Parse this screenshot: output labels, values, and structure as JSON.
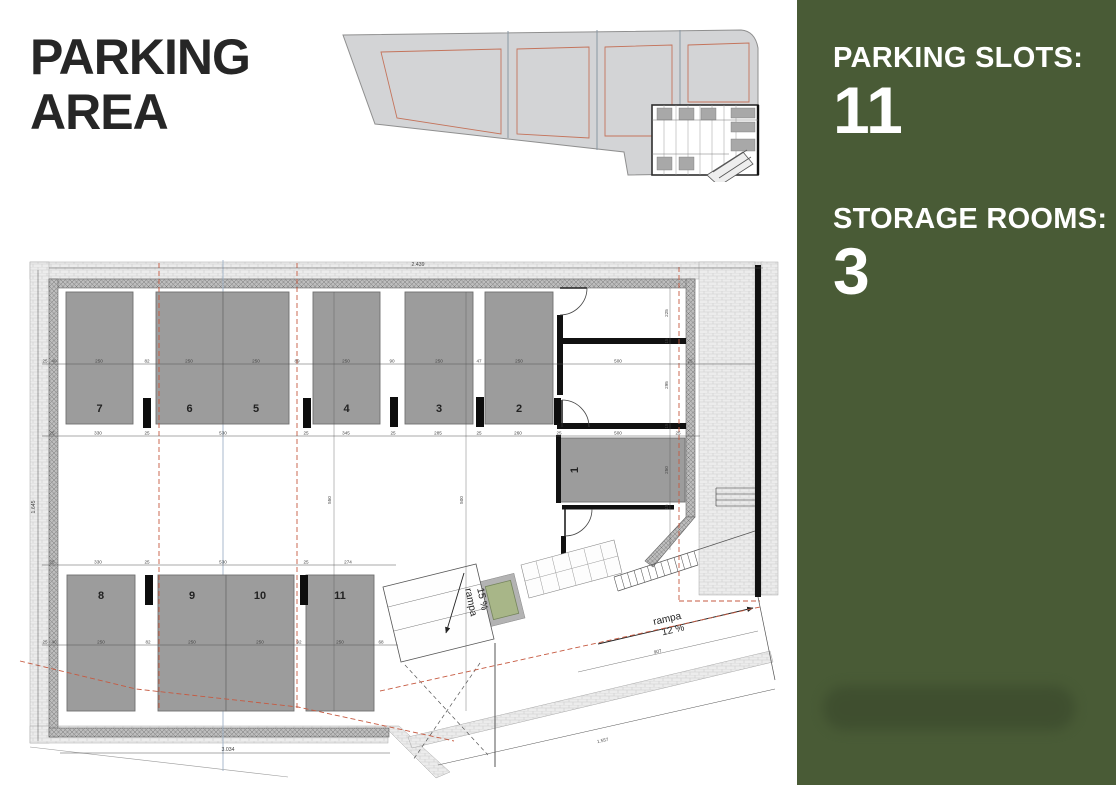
{
  "title": "PARKING AREA",
  "panel": {
    "bg_color": "#495B36",
    "stat1_label": "PARKING SLOTS:",
    "stat1_value": "11",
    "stat2_label": "STORAGE ROOMS:",
    "stat2_value": "3"
  },
  "plan": {
    "slot_numbers": [
      "1",
      "2",
      "3",
      "4",
      "5",
      "6",
      "7",
      "8",
      "9",
      "10",
      "11"
    ],
    "ramp_15": {
      "word": "rampa",
      "grade": "15 %"
    },
    "ramp_12": {
      "word": "rampa",
      "grade": "12 %"
    },
    "dims": {
      "top_width": "2.439",
      "left_height": "1.645",
      "bottom_width": "3.034",
      "d250": "250",
      "d330": "330",
      "d345": "345",
      "d285": "285",
      "d260": "260",
      "d274": "274",
      "d500": "500",
      "d530": "530",
      "d550": "550",
      "d225": "225",
      "d295": "295",
      "d25": "25",
      "d40": "40",
      "d82": "82",
      "d89": "89",
      "d90": "90",
      "d47": "47",
      "d92": "92",
      "d68": "68",
      "d15": "15",
      "d907": "907",
      "d1557": "1.557"
    },
    "colors": {
      "slot_fill": "#9c9c9c",
      "red_boundary": "#c65a41",
      "planter_green": "#a8b688",
      "wall_black": "#111111"
    }
  }
}
